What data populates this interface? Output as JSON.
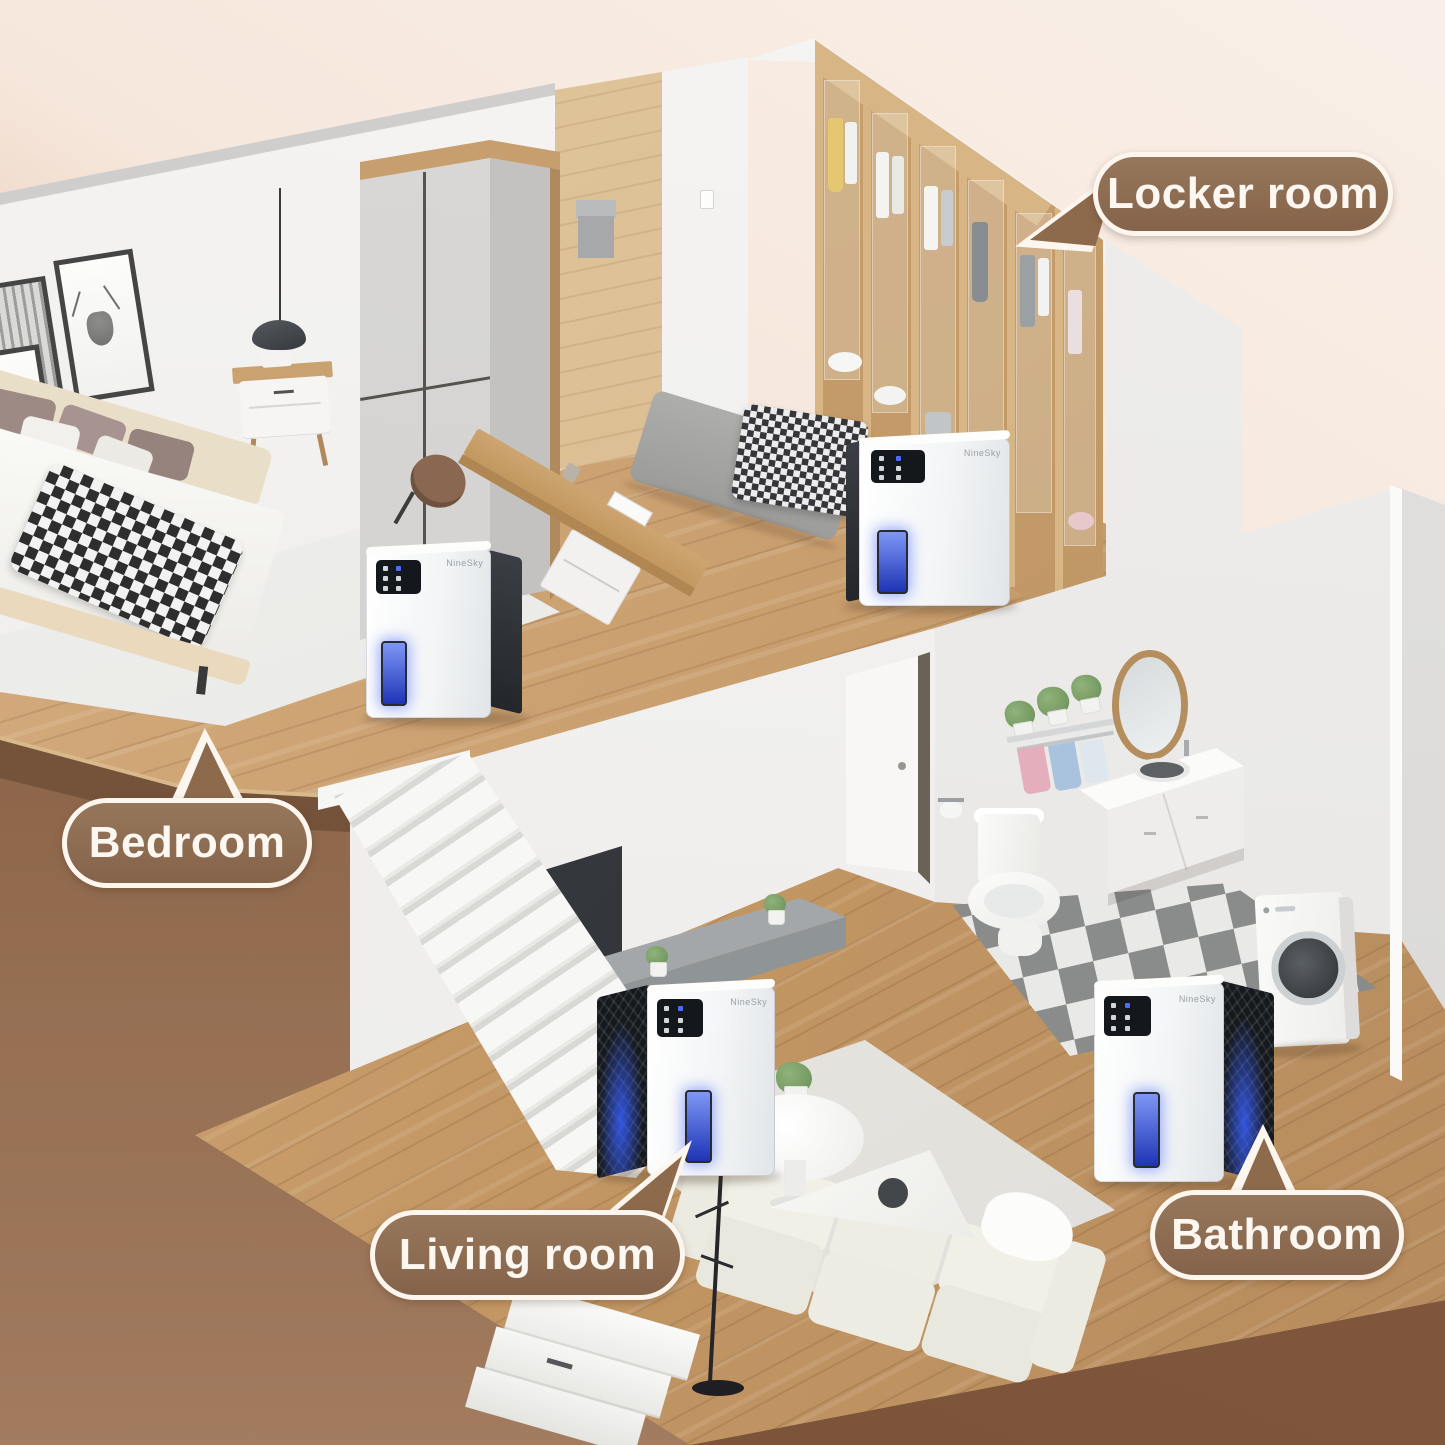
{
  "callouts": {
    "locker_room": "Locker room",
    "bedroom": "Bedroom",
    "living_room": "Living room",
    "bathroom": "Bathroom"
  },
  "device": {
    "brand": "NineSky"
  },
  "colors": {
    "callout_fill": "#8d6a4c",
    "callout_outline": "#fcf6ef",
    "callout_text": "#fcf7f1",
    "background_top": "#f9efe8",
    "background_bottom_left": "#92684c",
    "wood_floor": "#c69d6e",
    "wall_white": "#f3f2f0",
    "water_tank_blue": "#2e49d1",
    "bathroom_tile_dark": "#898c8b",
    "bathroom_tile_light": "#e9e9e7"
  }
}
